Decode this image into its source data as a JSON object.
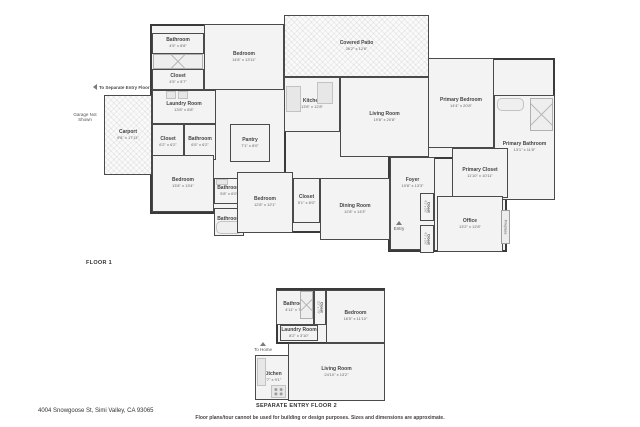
{
  "page": {
    "address": "4004 Snowgoose St, Simi Valley, CA 93065",
    "disclaimer": "Floor plans/tour cannot be used for building or design purposes. Sizes and dimensions are approximate."
  },
  "colors": {
    "wall": "#3a3a3a",
    "floor": "#f3f3f3",
    "fixture": "#e7e7e7",
    "accent_text": "#4a4a4a"
  },
  "floor1": {
    "caption": "FLOOR 1",
    "annotations": {
      "to_separate_entry": "To Separate Entry Floor 2",
      "garage_note": "Garage Not Shown",
      "entry": "Entry",
      "fireplace": "Fireplace"
    },
    "rooms": [
      {
        "name": "Bathroom",
        "dims": "4'5\" x 8'8\""
      },
      {
        "name": "Closet",
        "dims": "4'5\" x 5'7\""
      },
      {
        "name": "Bedroom",
        "dims": "14'8\" x 13'11\""
      },
      {
        "name": "Covered Patio",
        "dims": "36'2\" x 12'6\""
      },
      {
        "name": "Kitchen",
        "dims": "13'8\" x 12'8\""
      },
      {
        "name": "Living Room",
        "dims": "19'8\" x 20'8\""
      },
      {
        "name": "Laundry Room",
        "dims": "13'8\" x 8'8\""
      },
      {
        "name": "Carport",
        "dims": "9'8\" x 17'11\""
      },
      {
        "name": "Closet",
        "dims": "6'2\" x 6'2\""
      },
      {
        "name": "Bathroom",
        "dims": "6'5\" x 6'2\""
      },
      {
        "name": "Pantry",
        "dims": "7'1\" x 8'0\""
      },
      {
        "name": "Primary Bedroom",
        "dims": "14'4\" x 20'8\""
      },
      {
        "name": "Primary Bathroom",
        "dims": "13'1\" x 11'8\""
      },
      {
        "name": "Primary Closet",
        "dims": "11'10\" x 10'11\""
      },
      {
        "name": "Bedroom",
        "dims": "13'8\" x 13'4\""
      },
      {
        "name": "Bathroom",
        "dims": "5'8\" x 6'0\""
      },
      {
        "name": "Bathroom",
        "dims": "7'6\" x 6'1\""
      },
      {
        "name": "Bedroom",
        "dims": "12'8\" x 12'1\""
      },
      {
        "name": "Closet",
        "dims": "5'1\" x 8'0\""
      },
      {
        "name": "Dining Room",
        "dims": "12'8\" x 14'3\""
      },
      {
        "name": "Foyer",
        "dims": "10'8\" x 13'3\""
      },
      {
        "name": "Closet",
        "dims": "4'1\" x 2'6\""
      },
      {
        "name": "Closet",
        "dims": "4'1\" x 2'6\""
      },
      {
        "name": "Office",
        "dims": "13'2\" x 12'8\""
      }
    ]
  },
  "floor2": {
    "caption": "SEPARATE ENTRY FLOOR 2",
    "annotations": {
      "to_home": "To Home"
    },
    "rooms": [
      {
        "name": "Bathroom",
        "dims": "4'11\" x 7'6\""
      },
      {
        "name": "Closet",
        "dims": "2'2\" x 7'5\""
      },
      {
        "name": "Bedroom",
        "dims": "16'5\" x 11'10\""
      },
      {
        "name": "Laundry Room",
        "dims": "8'2\" x 3'10\""
      },
      {
        "name": "Kitchen",
        "dims": "7'7\" x 9'1\""
      },
      {
        "name": "Living Room",
        "dims": "24'10\" x 13'2\""
      }
    ]
  }
}
